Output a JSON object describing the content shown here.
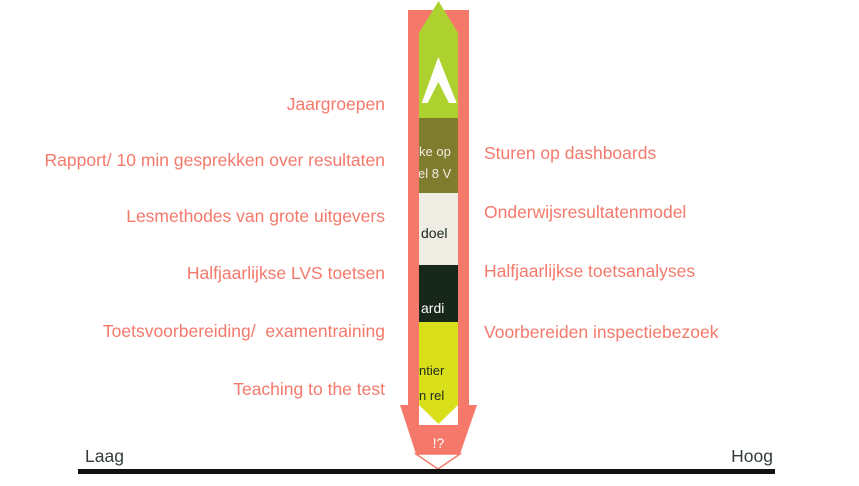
{
  "labels": {
    "left": [
      "Jaargroepen",
      "Rapport/ 10 min gesprekken over resultaten",
      "Lesmethodes van grote uitgevers",
      "Halfjaarlijkse LVS toetsen",
      "Toetsvoorbereiding/  examentraining",
      "Teaching to the test"
    ],
    "right": [
      "Sturen op dashboards",
      "Onderwijsresultatenmodel",
      "Halfjaarlijkse toetsanalyses",
      "Voorbereiden inspectiebezoek"
    ]
  },
  "axis": {
    "left": "Laag",
    "right": "Hoog"
  },
  "arrow": {
    "badge": "!?",
    "column_fragments": {
      "olive_line1": "ke op",
      "olive_line2": "el 8 V",
      "cream": "doel",
      "dark": "ardi",
      "yellow_line1": "ntier",
      "yellow_line2": "n rel"
    }
  },
  "colors": {
    "salmon": "#F4796B",
    "bright_green": "#ADD22F",
    "olive": "#807C2D",
    "cream": "#EFECE4",
    "dark_green": "#17281A",
    "yellow": "#DADF1B",
    "label_text": "#F4796B",
    "axis_text": "#333F36",
    "axis_line": "#111111"
  }
}
